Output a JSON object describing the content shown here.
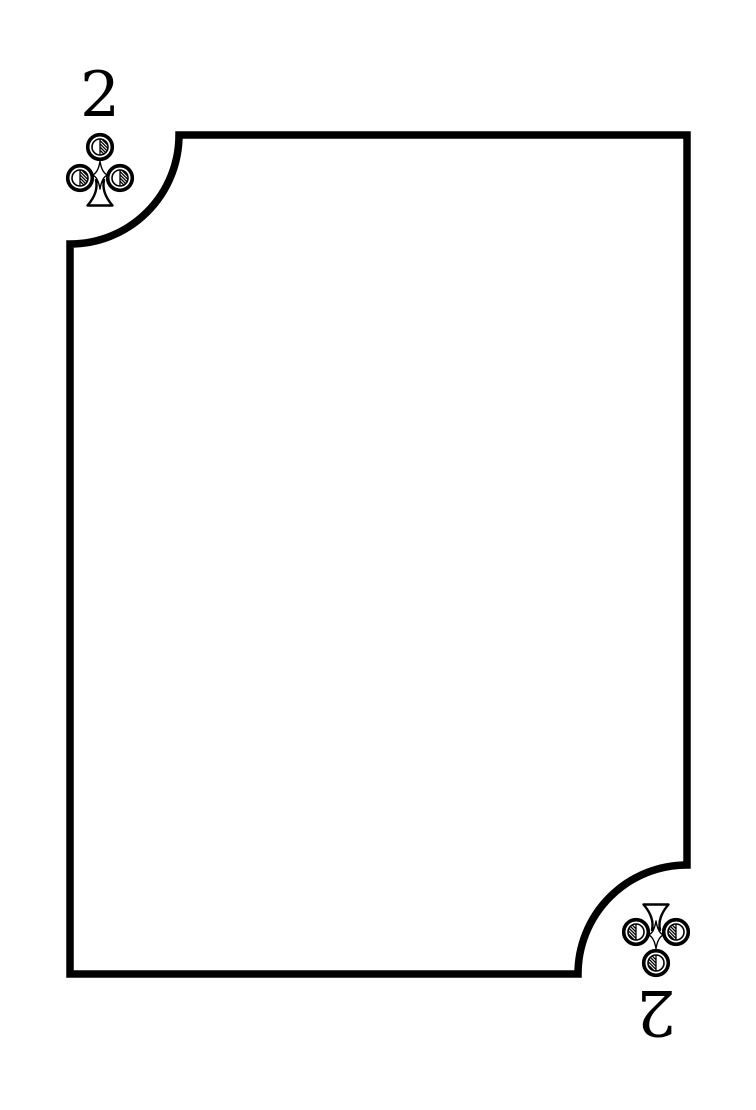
{
  "page": {
    "background_color": "#ffffff"
  },
  "card": {
    "rank": "2",
    "suit": "clubs",
    "pip_style": "outline-hatched",
    "ink_color": "#000000",
    "face_color": "#ffffff",
    "corners": {
      "top_left": {
        "rank": "2",
        "pip": "club"
      },
      "bottom_right": {
        "rank": "2",
        "pip": "club",
        "rotated": true
      }
    }
  }
}
